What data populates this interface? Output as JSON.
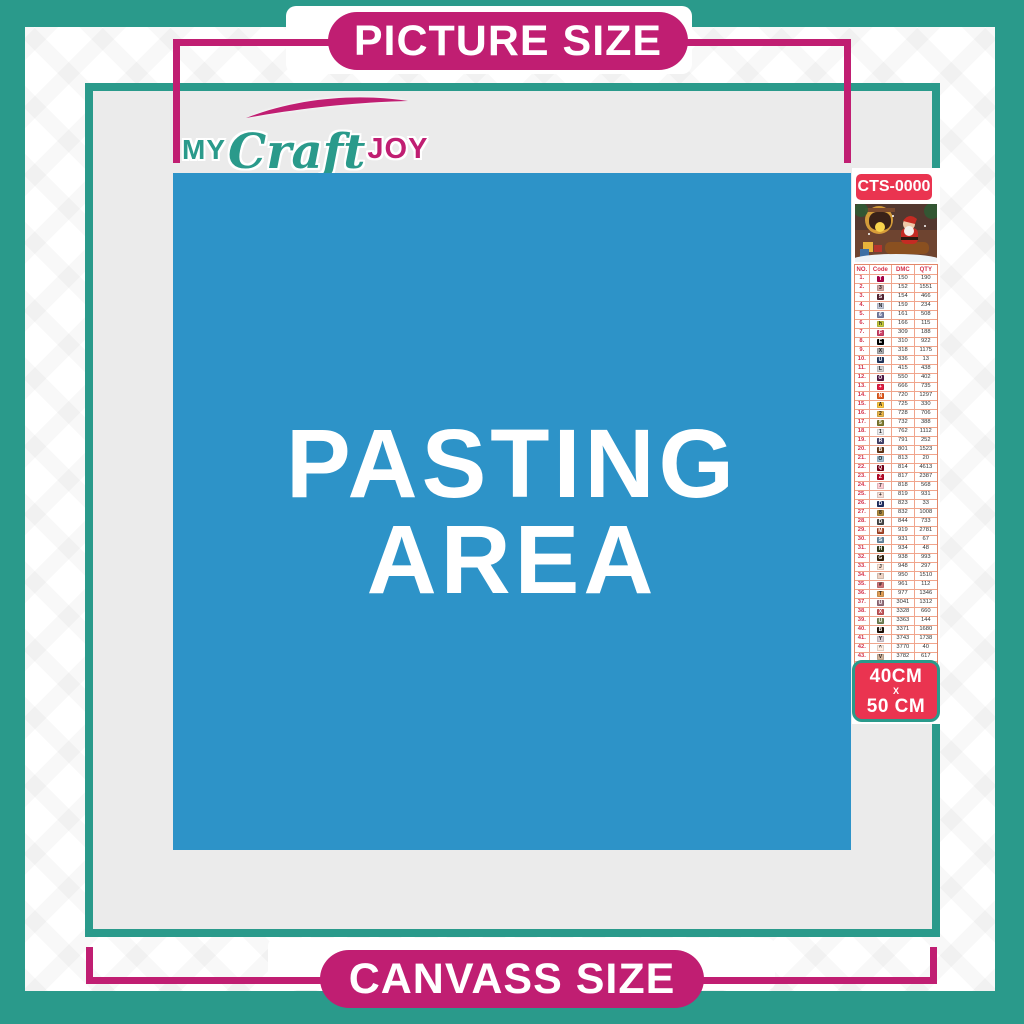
{
  "poster": {
    "top_banner": "PICTURE SIZE",
    "bottom_banner": "CANVASS SIZE",
    "pasting_line1": "PASTING",
    "pasting_line2": "AREA"
  },
  "logo": {
    "my": "MY",
    "craft": "Craft",
    "joy": "JOY"
  },
  "sidebar": {
    "sku": "CTS-0000",
    "thumbnail": "christmas-santa-sleigh-scene",
    "size": {
      "line1": "40CM",
      "sep": "X",
      "line2": "50 CM"
    },
    "table": {
      "headers": [
        "NO.",
        "Code",
        "DMC",
        "QTY"
      ],
      "rows": [
        {
          "no": "1.",
          "sym": "T",
          "chip": "#AB0249",
          "dmc": "150",
          "qty": "190"
        },
        {
          "no": "2.",
          "sym": "3",
          "chip": "#D1A7A4",
          "dmc": "152",
          "qty": "1551"
        },
        {
          "no": "3.",
          "sym": "S",
          "chip": "#572433",
          "dmc": "154",
          "qty": "466"
        },
        {
          "no": "4.",
          "sym": "N",
          "chip": "#C3C8DA",
          "dmc": "159",
          "qty": "234"
        },
        {
          "no": "5.",
          "sym": "6",
          "chip": "#7880A4",
          "dmc": "161",
          "qty": "508"
        },
        {
          "no": "6.",
          "sym": "h",
          "chip": "#C3C93D",
          "dmc": "166",
          "qty": "115"
        },
        {
          "no": "7.",
          "sym": "F",
          "chip": "#CF4369",
          "dmc": "309",
          "qty": "188"
        },
        {
          "no": "8.",
          "sym": "E",
          "chip": "#000000",
          "dmc": "310",
          "qty": "922"
        },
        {
          "no": "9.",
          "sym": "X",
          "chip": "#ACACAE",
          "dmc": "318",
          "qty": "1175"
        },
        {
          "no": "10.",
          "sym": "U",
          "chip": "#25385F",
          "dmc": "336",
          "qty": "13"
        },
        {
          "no": "11.",
          "sym": "L",
          "chip": "#D2D2D5",
          "dmc": "415",
          "qty": "438"
        },
        {
          "no": "12.",
          "sym": "O",
          "chip": "#551A46",
          "dmc": "550",
          "qty": "402"
        },
        {
          "no": "13.",
          "sym": "+",
          "chip": "#E31D42",
          "dmc": "666",
          "qty": "735"
        },
        {
          "no": "14.",
          "sym": "N",
          "chip": "#E55C1F",
          "dmc": "720",
          "qty": "1297"
        },
        {
          "no": "15.",
          "sym": "A",
          "chip": "#FFC840",
          "dmc": "725",
          "qty": "330"
        },
        {
          "no": "16.",
          "sym": "2",
          "chip": "#E8B64A",
          "dmc": "728",
          "qty": "706"
        },
        {
          "no": "17.",
          "sym": "5",
          "chip": "#7E7B30",
          "dmc": "732",
          "qty": "388"
        },
        {
          "no": "18.",
          "sym": "1",
          "chip": "#E9E9EB",
          "dmc": "762",
          "qty": "1112"
        },
        {
          "no": "19.",
          "sym": "R",
          "chip": "#45436B",
          "dmc": "791",
          "qty": "252"
        },
        {
          "no": "20.",
          "sym": "B",
          "chip": "#653919",
          "dmc": "801",
          "qty": "1523"
        },
        {
          "no": "21.",
          "sym": "O",
          "chip": "#A1C2D7",
          "dmc": "813",
          "qty": "20"
        },
        {
          "no": "22.",
          "sym": "Q",
          "chip": "#7B0018",
          "dmc": "814",
          "qty": "4613"
        },
        {
          "no": "23.",
          "sym": "Z",
          "chip": "#BB0A28",
          "dmc": "817",
          "qty": "2387"
        },
        {
          "no": "24.",
          "sym": "7",
          "chip": "#FFCDD3",
          "dmc": "818",
          "qty": "568"
        },
        {
          "no": "25.",
          "sym": "+",
          "chip": "#F6DFD8",
          "dmc": "819",
          "qty": "931"
        },
        {
          "no": "26.",
          "sym": "D",
          "chip": "#213063",
          "dmc": "823",
          "qty": "33"
        },
        {
          "no": "27.",
          "sym": "8",
          "chip": "#B08C3E",
          "dmc": "832",
          "qty": "1008"
        },
        {
          "no": "28.",
          "sym": "D",
          "chip": "#484848",
          "dmc": "844",
          "qty": "733"
        },
        {
          "no": "29.",
          "sym": "M",
          "chip": "#A64526",
          "dmc": "919",
          "qty": "2781"
        },
        {
          "no": "30.",
          "sym": "S",
          "chip": "#6B8BA4",
          "dmc": "931",
          "qty": "67"
        },
        {
          "no": "31.",
          "sym": "H",
          "chip": "#313919",
          "dmc": "934",
          "qty": "48"
        },
        {
          "no": "32.",
          "sym": "G",
          "chip": "#36220C",
          "dmc": "938",
          "qty": "993"
        },
        {
          "no": "33.",
          "sym": "J",
          "chip": "#FEE3D4",
          "dmc": "948",
          "qty": "297"
        },
        {
          "no": "34.",
          "sym": "*",
          "chip": "#EED3C4",
          "dmc": "950",
          "qty": "1510"
        },
        {
          "no": "35.",
          "sym": "#",
          "chip": "#CF7479",
          "dmc": "961",
          "qty": "112"
        },
        {
          "no": "36.",
          "sym": "T",
          "chip": "#DC9C56",
          "dmc": "977",
          "qty": "1346"
        },
        {
          "no": "37.",
          "sym": "U",
          "chip": "#956F7C",
          "dmc": "3041",
          "qty": "1312"
        },
        {
          "no": "38.",
          "sym": "X",
          "chip": "#C4565A",
          "dmc": "3328",
          "qty": "660"
        },
        {
          "no": "39.",
          "sym": "U",
          "chip": "#728256",
          "dmc": "3363",
          "qty": "144"
        },
        {
          "no": "40.",
          "sym": "B",
          "chip": "#1E1108",
          "dmc": "3371",
          "qty": "1680"
        },
        {
          "no": "41.",
          "sym": "Y",
          "chip": "#D7CBD3",
          "dmc": "3743",
          "qty": "1738"
        },
        {
          "no": "42.",
          "sym": "^",
          "chip": "#FFEEE3",
          "dmc": "3770",
          "qty": "40"
        },
        {
          "no": "43.",
          "sym": "V",
          "chip": "#D2B49C",
          "dmc": "3782",
          "qty": "617"
        },
        {
          "no": "44.",
          "sym": "2",
          "chip": "#E0E868",
          "dmc": "3819",
          "qty": "119"
        },
        {
          "no": "45.",
          "sym": "✓",
          "chip": "#FFFDE3",
          "dmc": "3823",
          "qty": "107"
        },
        {
          "no": "46.",
          "sym": "C",
          "chip": "#F29746",
          "dmc": "3853",
          "qty": "1332"
        },
        {
          "no": "47.",
          "sym": "M",
          "chip": "#8B4A47",
          "dmc": "3858",
          "qty": "2311"
        },
        {
          "no": "48.",
          "sym": "A",
          "chip": "#A4835C",
          "dmc": "3863",
          "qty": "1820"
        }
      ]
    }
  },
  "colors": {
    "teal": "#2A9A8B",
    "magenta": "#C01E72",
    "red": "#EA3450",
    "blue": "#2D93C8",
    "canvas_gray": "#EBEBEB"
  }
}
